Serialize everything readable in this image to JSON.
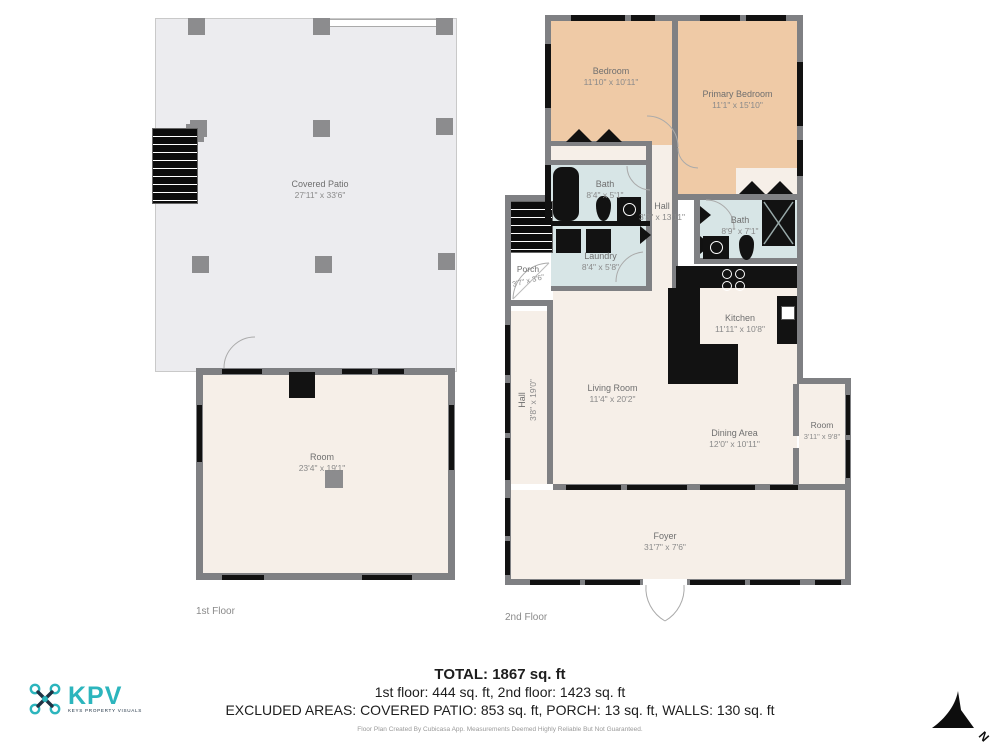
{
  "floors": [
    {
      "label": "1st Floor",
      "rooms": {
        "covered_patio": {
          "name": "Covered Patio",
          "dims": "27'11\" x 33'6\""
        },
        "room": {
          "name": "Room",
          "dims": "23'4\" x 19'1\""
        }
      }
    },
    {
      "label": "2nd Floor",
      "rooms": {
        "bedroom": {
          "name": "Bedroom",
          "dims": "11'10\" x 10'11\""
        },
        "primary_bedroom": {
          "name": "Primary Bedroom",
          "dims": "11'1\" x 15'10\""
        },
        "bath1": {
          "name": "Bath",
          "dims": "8'4\" x 5'1\""
        },
        "hall1": {
          "name": "Hall",
          "dims": "3'3\" x 13'11\""
        },
        "bath2": {
          "name": "Bath",
          "dims": "8'9\" x 7'1\""
        },
        "laundry": {
          "name": "Laundry",
          "dims": "8'4\" x 5'8\""
        },
        "porch": {
          "name": "Porch",
          "dims": "3'7\" x 3'6\""
        },
        "kitchen": {
          "name": "Kitchen",
          "dims": "11'11\" x 10'8\""
        },
        "living_room": {
          "name": "Living Room",
          "dims": "11'4\" x 20'2\""
        },
        "hall2": {
          "name": "Hall",
          "dims": "3'8\" x 19'0\""
        },
        "dining_area": {
          "name": "Dining Area",
          "dims": "12'0\" x 10'11\""
        },
        "room_right": {
          "name": "Room",
          "dims": "3'11\" x 9'8\""
        },
        "foyer": {
          "name": "Foyer",
          "dims": "31'7\" x 7'6\""
        }
      }
    }
  ],
  "summary": {
    "total": "TOTAL: 1867 sq. ft",
    "floors_line": "1st floor: 444 sq. ft, 2nd floor: 1423 sq. ft",
    "excluded_line": "EXCLUDED AREAS: COVERED PATIO: 853 sq. ft, PORCH: 13 sq. ft, WALLS: 130 sq. ft"
  },
  "footer": {
    "disclaimer": "Floor Plan Created By Cubicasa App. Measurements Deemed Highly Reliable But Not Guaranteed."
  },
  "logo": {
    "name": "KPV",
    "tagline": "KEYS PROPERTY VISUALS"
  },
  "compass": {
    "label": "N"
  },
  "colors": {
    "wall": "#7f8083",
    "room_fill": "#f6efe8",
    "bedroom_fill": "#efcaa6",
    "wet_fill": "#d7e5e6",
    "patio_fill": "#ececef",
    "fixture": "#121212",
    "accent_teal": "#2cb5bd"
  }
}
